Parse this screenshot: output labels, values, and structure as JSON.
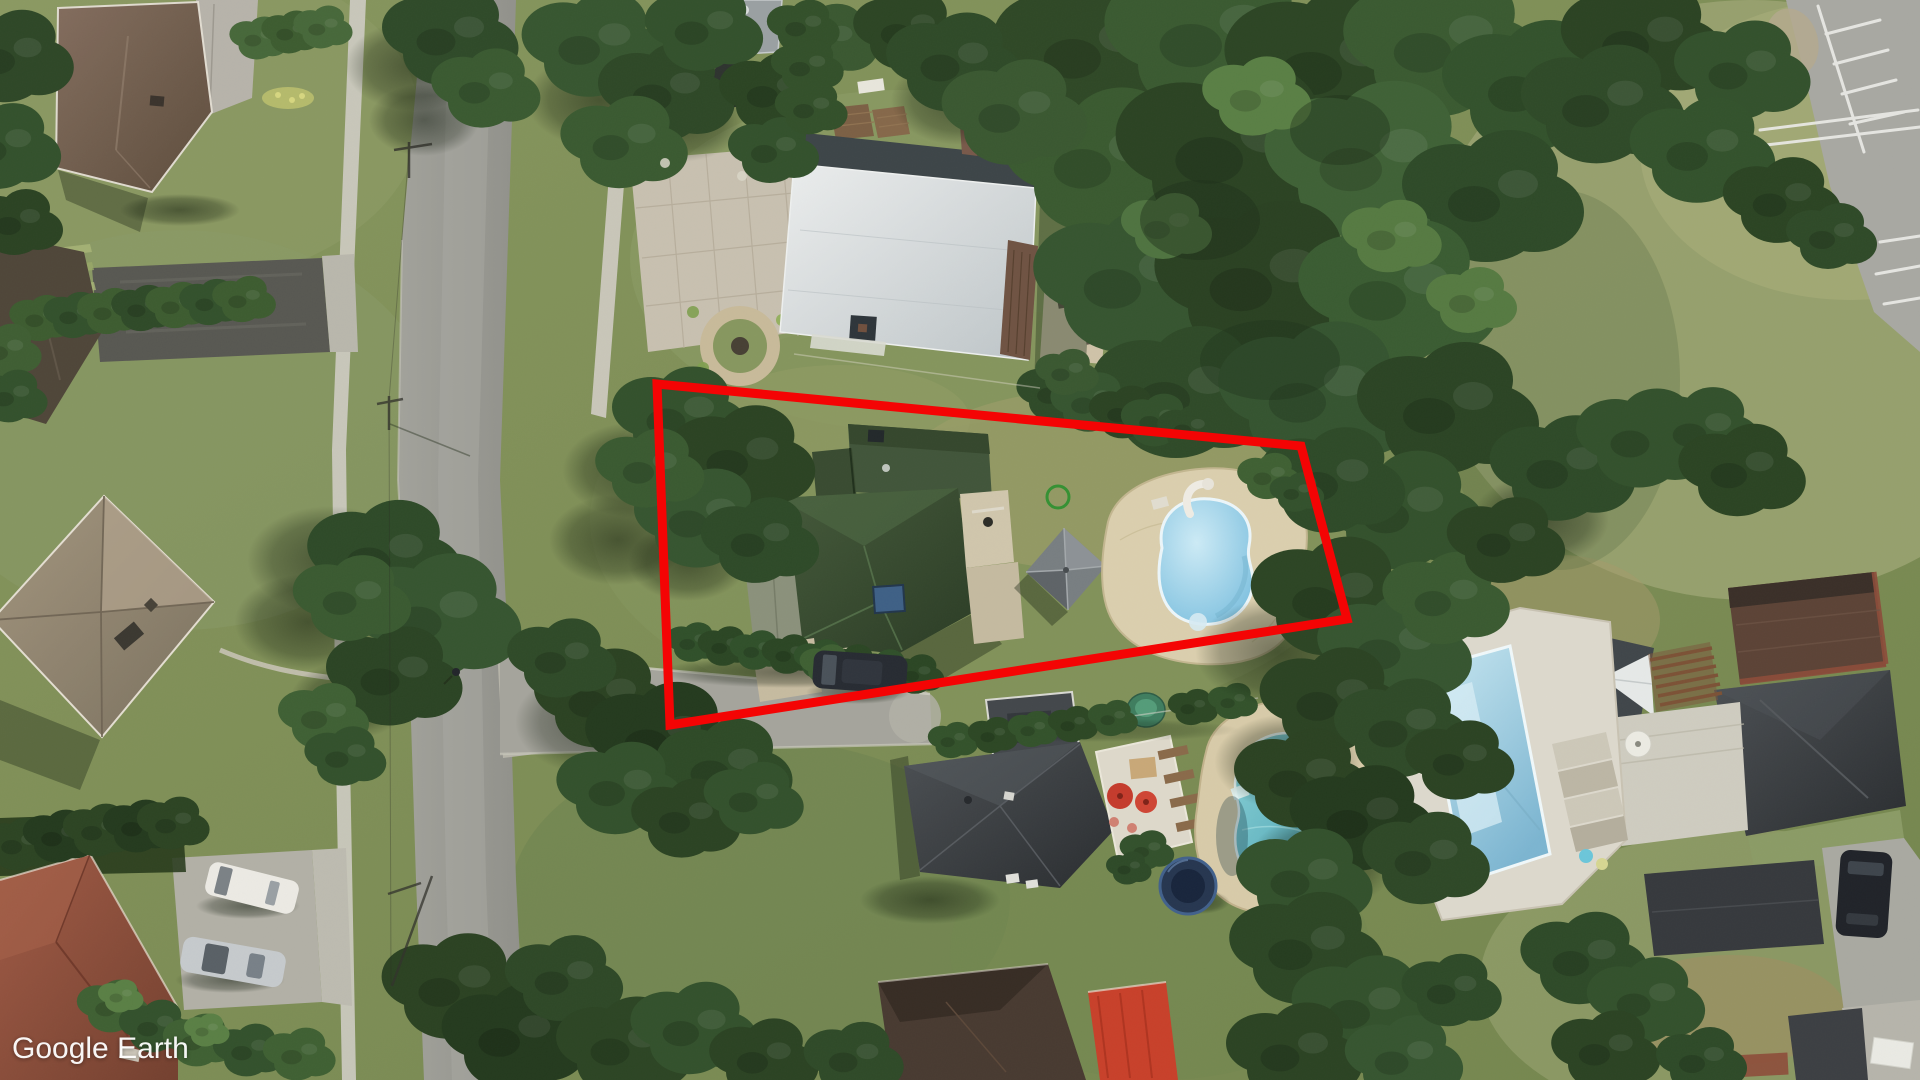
{
  "app": {
    "name": "Google Earth",
    "watermark": "Google Earth"
  },
  "view": {
    "type": "satellite-aerial-imagery",
    "scene": "suburban-neighborhood-overhead-view",
    "annotation": {
      "shape": "property-boundary-quadrilateral",
      "points": "657,384 1301,446 1347,619 670,725",
      "stroke_color": "#f40404",
      "stroke_width": 9
    },
    "colors": {
      "red_outline": "#f40404",
      "watermark_text": "#ffffff",
      "grass": "#7e8f5a",
      "forest": "#2e4726",
      "road": "#9b9b94",
      "sidewalk": "#cbc9bf",
      "pool_water_blue": "#8ccbe6",
      "pool_cover_teal": "#55aab6",
      "deck_beige": "#d8cbaa",
      "roof_green": "#36492e",
      "roof_charcoal": "#3a3e42",
      "roof_brown": "#755f50",
      "roof_rust": "#8d4c3a",
      "roof_white": "#d8dddf",
      "awning_red": "#c8402a",
      "umbrella_red": "#c53b2c",
      "marker_green": "#2f9030"
    },
    "features": [
      "forest-tree-canopy",
      "residential-lawns",
      "dry-grass-field",
      "main-road",
      "side-street",
      "sidewalks",
      "paver-driveway",
      "parking-lot-with-stall-stripes",
      "brown-roof-house",
      "tan-hip-roof-house",
      "rust-roof-house",
      "white-flat-roof-building",
      "green-roof-house",
      "square-gazebo",
      "kidney-pool-with-slide",
      "teal-covered-pool",
      "rectangular-pool",
      "trampoline",
      "garden-pond",
      "parked-cars",
      "utility-pole-shadows",
      "pedestrian",
      "green-circle-marker",
      "red-property-outline",
      "google-earth-watermark"
    ]
  }
}
